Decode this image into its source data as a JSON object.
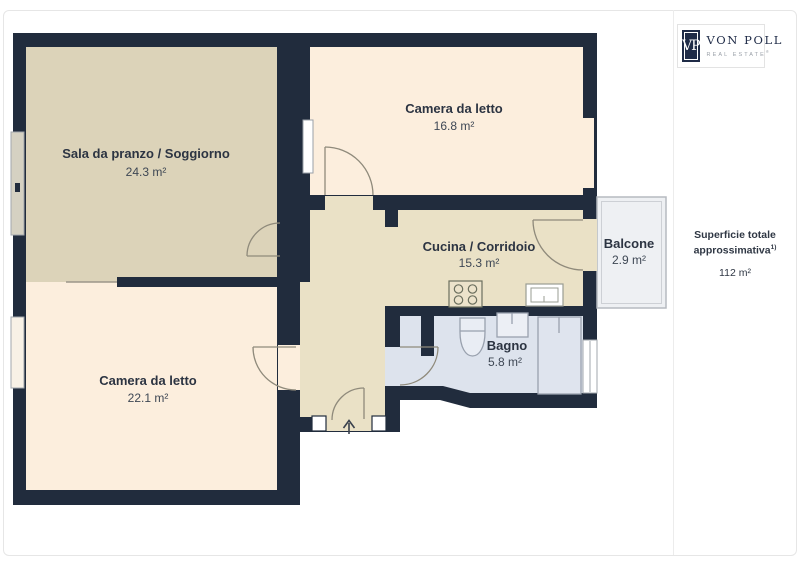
{
  "brand": {
    "initials": "VP",
    "name": "VON POLL",
    "tagline": "REAL ESTATE",
    "registered_mark": "®"
  },
  "summary": {
    "title_line1": "Superficie totale",
    "title_line2": "approssimativa",
    "note_mark": "1)",
    "total_area": "112 m²"
  },
  "rooms": {
    "living": {
      "name": "Sala da pranzo / Soggiorno",
      "area": "24.3 m²"
    },
    "bedroom_top": {
      "name": "Camera da letto",
      "area": "16.8 m²"
    },
    "kitchen_corridor": {
      "name": "Cucina / Corridoio",
      "area": "15.3 m²"
    },
    "balcony": {
      "name": "Balcone",
      "area": "2.9 m²"
    },
    "bedroom_bottom": {
      "name": "Camera da letto",
      "area": "22.1 m²"
    },
    "bathroom": {
      "name": "Bagno",
      "area": "5.8 m²"
    }
  },
  "colors": {
    "wall": "#212c3d",
    "living_floor": "#dcd3b9",
    "bedroom_floor": "#fceedd",
    "kitchen_floor": "#eae1c6",
    "bathroom_floor": "#dde3ed",
    "balcony_floor": "#eef0f3",
    "logo_navy": "#1f2b47"
  }
}
